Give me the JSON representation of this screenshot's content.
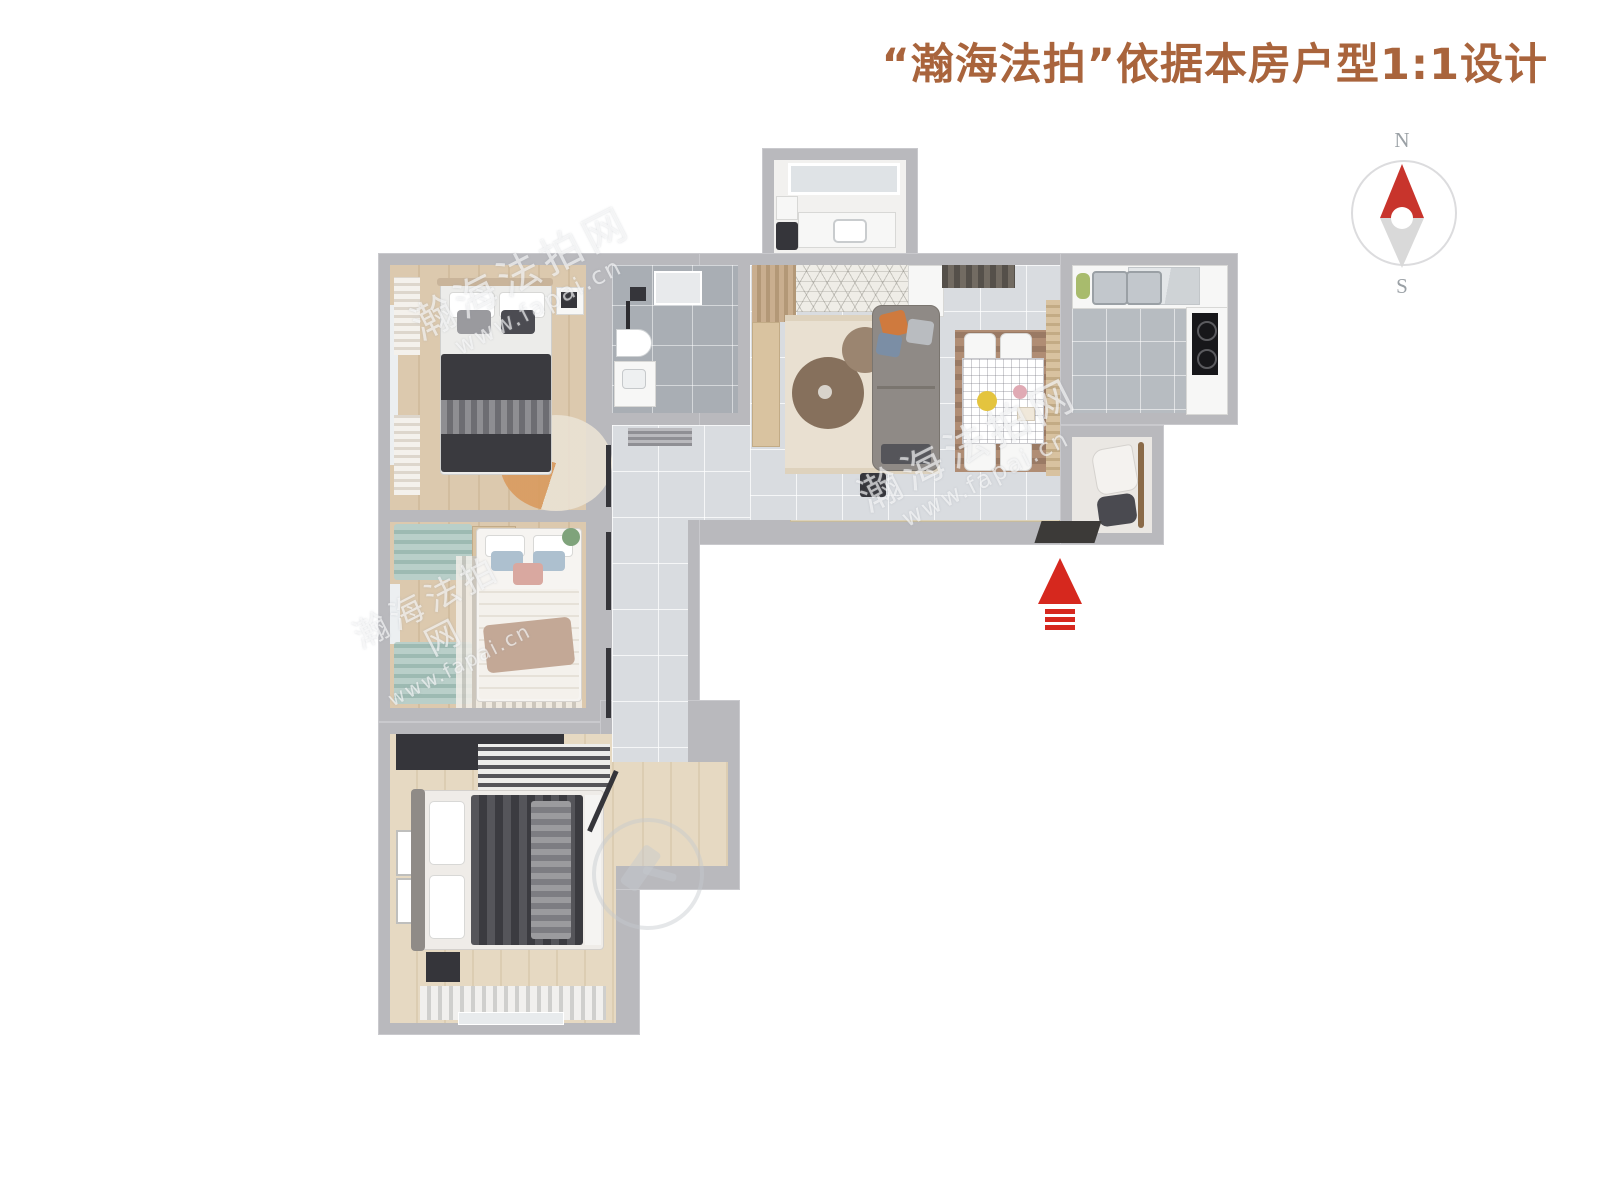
{
  "title": {
    "text": "“瀚海法拍”依据本房户型1:1设计",
    "color": "#a9643c"
  },
  "compass": {
    "north": "N",
    "south": "S",
    "needle_north_color": "#c8342c",
    "needle_south_color": "#d9d9d9",
    "ring_color": "#dcdcde"
  },
  "entrance": {
    "arrow_color": "#d6281e"
  },
  "watermark": {
    "brand": "瀚海法拍网",
    "url": "www.fapai.cn"
  },
  "icons": {
    "compass": "compass-rose-icon",
    "entrance": "entrance-arrow-up-icon",
    "watermark_logo": "gavel-circle-icon"
  },
  "palette": {
    "background": "#ffffff",
    "wall": "#b9b9bd",
    "wood_floor": "#dcc9ae",
    "tile_floor": "#d9dce0",
    "marble_floor": "#a9aeb4",
    "title_color": "#a9643c",
    "accent_red": "#d6281e"
  }
}
